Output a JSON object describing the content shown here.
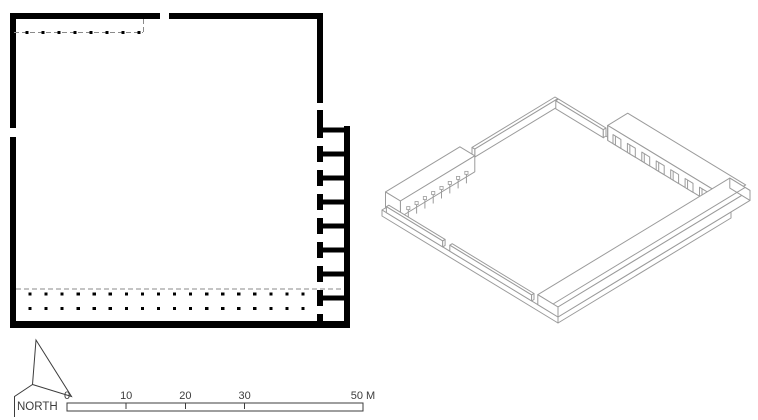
{
  "labels": {
    "north": "NORTH"
  },
  "scale_bar": {
    "length_meters": 50,
    "ticks": [
      {
        "label": "0",
        "meters": 0
      },
      {
        "label": "10",
        "meters": 10
      },
      {
        "label": "20",
        "meters": 20
      },
      {
        "label": "30",
        "meters": 30
      },
      {
        "label": "50 M",
        "meters": 50
      }
    ]
  },
  "plan": {
    "portico_column_count": 8,
    "side_room_count": 8,
    "side_room_doorway_count": 8,
    "colonnade_dot_rows": 2,
    "colonnade_dots_per_row": 18
  },
  "isometric": {
    "portico_post_count": 8,
    "side_room_notch_count": 8
  },
  "colors": {
    "background": "#ffffff",
    "plan_ink": "#000000",
    "dashed_line": "#8a8a8a",
    "annotation_ink": "#3c3c3c",
    "iso_line": "#9b9b9b"
  }
}
